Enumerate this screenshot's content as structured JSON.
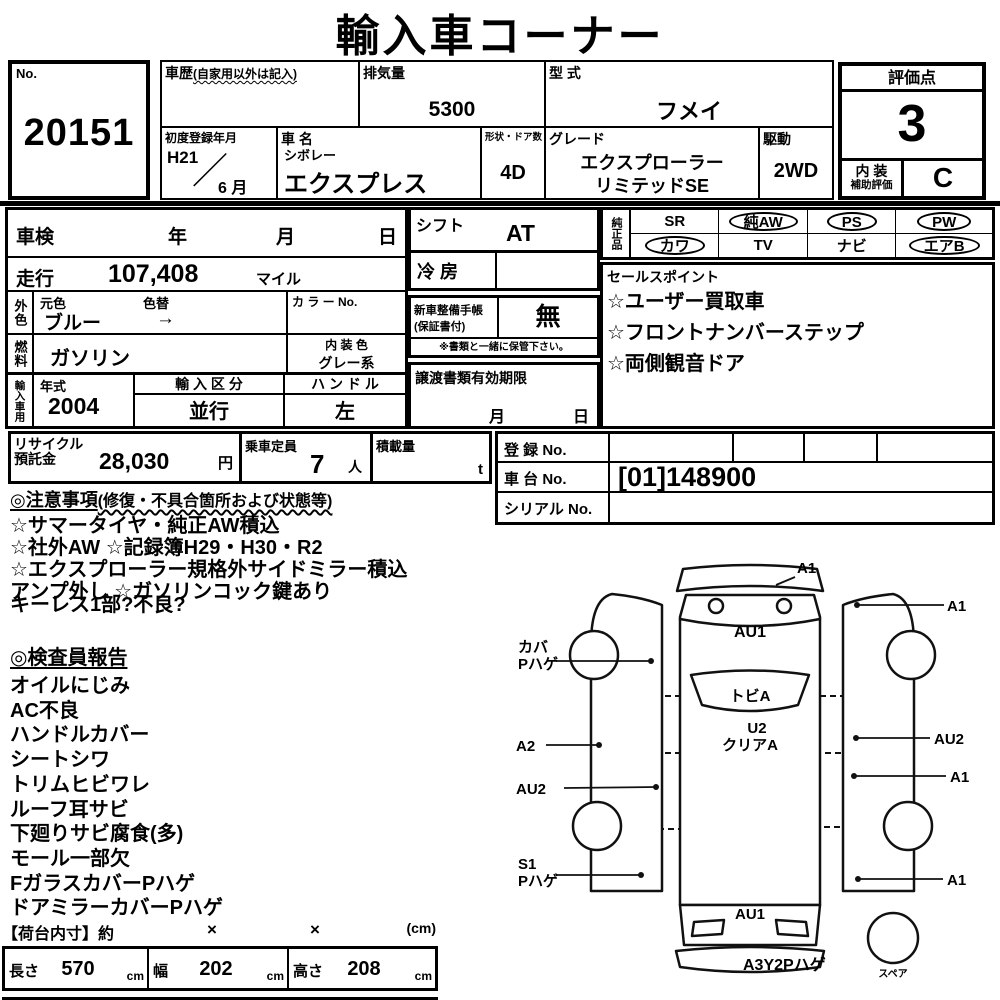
{
  "title": "輸入車コーナー",
  "header": {
    "no_label": "No.",
    "no_value": "20151",
    "history_label": "車歴",
    "history_note": "(自家用以外は記入)",
    "displacement_label": "排気量",
    "displacement_value": "5300",
    "model_code_label": "型 式",
    "model_code_value": "フメイ",
    "first_reg_label": "初度登録年月",
    "first_reg_year": "H21",
    "first_reg_month": "6 月",
    "car_name_label": "車 名",
    "car_maker": "シボレー",
    "car_name_value": "エクスプレス",
    "body_doors_label": "形状・ドア数",
    "body_doors_value": "4D",
    "grade_label": "グレード",
    "grade_line1": "エクスプローラー",
    "grade_line2": "リミテッドSE",
    "drive_label": "駆動",
    "drive_value": "2WD"
  },
  "rating": {
    "label": "評価点",
    "score": "3",
    "interior_label1": "内 装",
    "interior_label2": "補助評価",
    "interior_grade": "C"
  },
  "inspection": {
    "label": "車検",
    "year": "年",
    "month": "月",
    "day": "日"
  },
  "mileage": {
    "label": "走行",
    "value": "107,408",
    "unit": "マイル"
  },
  "exterior": {
    "label": "外色",
    "orig_label": "元色",
    "orig_value": "ブルー",
    "change_label": "色替",
    "arrow": "→",
    "color_no_label": "カ ラ ー No."
  },
  "fuel": {
    "label": "燃料",
    "value": "ガソリン",
    "interior_color_label": "内 装 色",
    "interior_color_value": "グレー系"
  },
  "import_use": {
    "label": "輸入車用",
    "year_label": "年式",
    "year_value": "2004",
    "class_label": "輸 入 区 分",
    "class_value": "並行",
    "handle_label": "ハ ン ド ル",
    "handle_value": "左"
  },
  "shift": {
    "label": "シフト",
    "value": "AT"
  },
  "aircon": {
    "label": "冷 房",
    "value": ""
  },
  "service_book": {
    "label1": "新車整備手帳",
    "label2": "(保証書付)",
    "value": "無",
    "note": "※書類と一緒に保管下さい。"
  },
  "transfer_docs": {
    "label": "譲渡書類有効期限",
    "month": "月",
    "day": "日"
  },
  "equipment": {
    "label": "純正品",
    "items": [
      {
        "label": "SR",
        "circled": false
      },
      {
        "label": "純AW",
        "circled": true
      },
      {
        "label": "PS",
        "circled": true
      },
      {
        "label": "PW",
        "circled": true
      },
      {
        "label": "カワ",
        "circled": true
      },
      {
        "label": "TV",
        "circled": false
      },
      {
        "label": "ナビ",
        "circled": false
      },
      {
        "label": "エアB",
        "circled": true
      }
    ]
  },
  "sales_points": {
    "label": "セールスポイント",
    "items": [
      "☆ユーザー買取車",
      "☆フロントナンバーステップ",
      "☆両側観音ドア"
    ]
  },
  "recycle": {
    "label1": "リサイクル",
    "label2": "預託金",
    "value": "28,030",
    "unit": "円"
  },
  "capacity": {
    "label": "乗車定員",
    "value": "7",
    "unit": "人"
  },
  "load": {
    "label": "積載量",
    "unit": "t"
  },
  "registration": {
    "reg_label": "登 録 No.",
    "chassis_label": "車 台 No.",
    "chassis_value": "[01]148900",
    "serial_label": "シリアル No."
  },
  "notes": {
    "header1": "◎注意事項",
    "header2": "(修復・不具合箇所および状態等)",
    "lines": [
      "☆サマータイヤ・純正AW積込",
      "☆社外AW ☆記録簿H29・H30・R2",
      "☆エクスプローラー規格外サイドミラー積込",
      "アンプ外し ☆ガソリンコック鍵あり"
    ],
    "extra": "キーレス1部?不良?"
  },
  "inspector_report": {
    "header": "◎検査員報告",
    "lines": [
      "オイルにじみ",
      "AC不良",
      "ハンドルカバー",
      "シートシワ",
      "トリムヒビワレ",
      "ルーフ耳サビ",
      "下廻りサビ腐食(多)",
      "モール一部欠",
      "FガラスカバーPハゲ",
      "ドアミラーカバーPハゲ"
    ]
  },
  "cargo": {
    "header": "【荷台内寸】約",
    "times1": "×",
    "times2": "×",
    "unit_note": "(cm)",
    "length_label": "長さ",
    "length_value": "570",
    "width_label": "幅",
    "width_value": "202",
    "height_label": "高さ",
    "height_value": "208",
    "cm": "cm"
  },
  "diagram": {
    "front_bumper_mark": "A1",
    "right_front_fender_mark": "A1",
    "hood_mark": "AU1",
    "left_wheel_mark1": "カバ",
    "left_wheel_mark2": "Pハゲ",
    "windshield_mark": "トビA",
    "roof_mark1": "U2",
    "roof_mark2": "クリアA",
    "left_door_mark": "A2",
    "right_slide_door_mark": "AU2",
    "left_slide_door_mark": "AU2",
    "right_panel_mark": "A1",
    "left_rear_mark1": "S1",
    "left_rear_mark2": "Pハゲ",
    "right_rear_mark": "A1",
    "rear_gate_mark": "AU1",
    "rear_bumper_mark": "A3Y2Pハゲ",
    "spare_label": "スペア"
  }
}
